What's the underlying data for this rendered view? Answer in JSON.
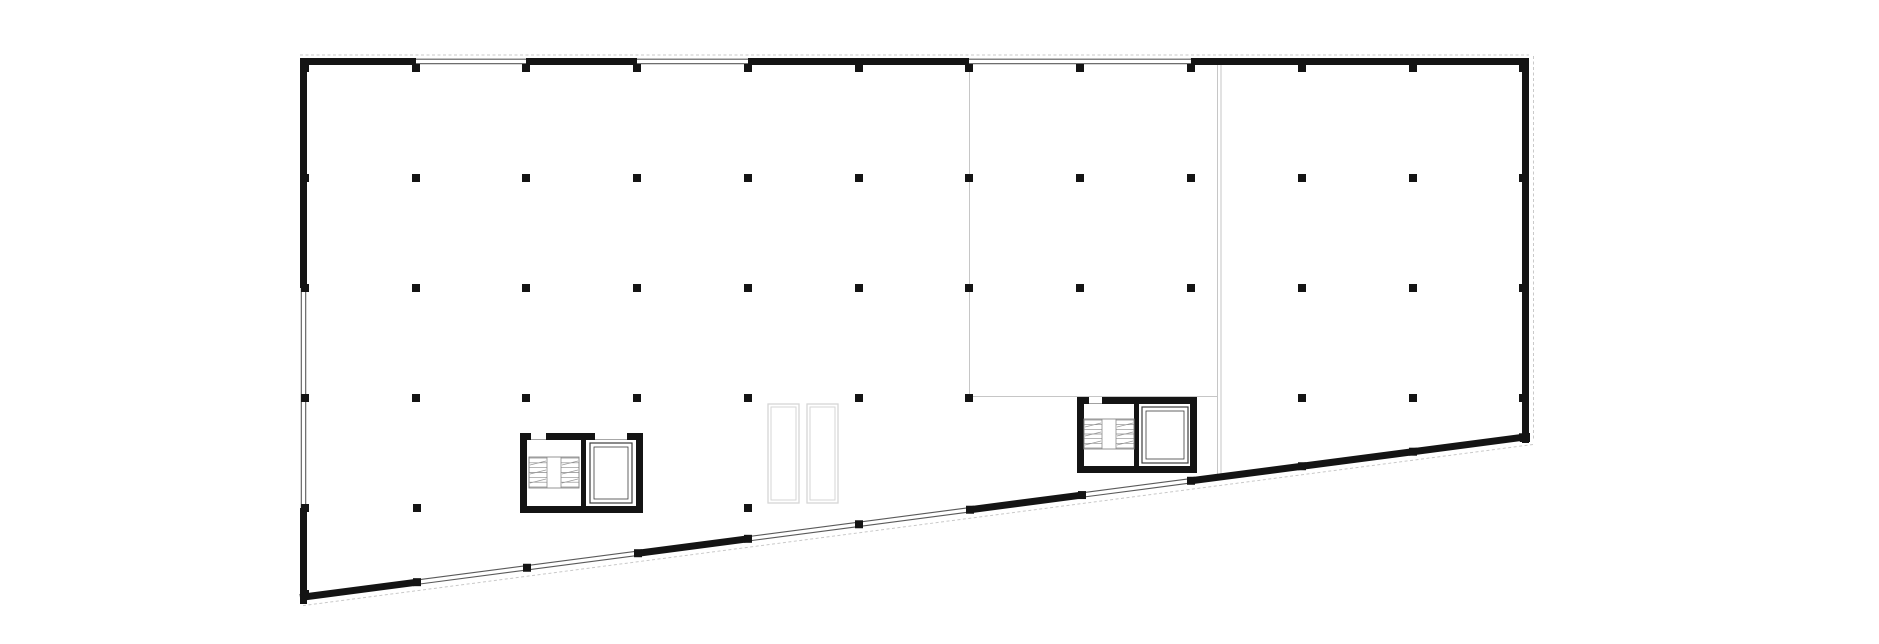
{
  "page": {
    "title": "architectural-floor-plan",
    "background": "#ffffff",
    "visible_text": []
  },
  "plan": {
    "canvas": {
      "w": 1879,
      "h": 644
    },
    "colors": {
      "wall": "#141414",
      "column": "#141414",
      "window_line": "#5a5a5a",
      "partition": "#c6c6c6",
      "dashed": "#c9c9c9",
      "lightwell": "#d6d6d6",
      "stair": "#8a8a8a",
      "elevator": "#3d3d3d",
      "white": "#ffffff"
    },
    "wall_thickness": 7,
    "top_wall_y": 61.5,
    "left_wall_x": 303.5,
    "right_wall_x": 1525.5,
    "right_wall_y1": 58,
    "right_wall_y2": 443,
    "slope": {
      "x0": 300,
      "y0": 597.5,
      "x1": 1529,
      "y1": 436.5
    },
    "top_bays": [
      {
        "x1": 300,
        "x2": 416,
        "type": "solid"
      },
      {
        "x1": 416,
        "x2": 526,
        "type": "window"
      },
      {
        "x1": 526,
        "x2": 637,
        "type": "solid"
      },
      {
        "x1": 637,
        "x2": 748,
        "type": "window"
      },
      {
        "x1": 748,
        "x2": 969,
        "type": "solid"
      },
      {
        "x1": 969,
        "x2": 1191,
        "type": "window"
      },
      {
        "x1": 1191,
        "x2": 1529,
        "type": "solid"
      }
    ],
    "bottom_bays": [
      {
        "x1": 300,
        "x2": 417,
        "type": "solid"
      },
      {
        "x1": 417,
        "x2": 638,
        "type": "window"
      },
      {
        "x1": 638,
        "x2": 748,
        "type": "solid"
      },
      {
        "x1": 748,
        "x2": 969,
        "type": "window"
      },
      {
        "x1": 969,
        "x2": 1082,
        "type": "solid"
      },
      {
        "x1": 1082,
        "x2": 1191,
        "type": "window"
      },
      {
        "x1": 1191,
        "x2": 1529,
        "type": "solid"
      }
    ],
    "left_segments": [
      {
        "y1": 58,
        "y2": 288,
        "type": "solid"
      },
      {
        "y1": 288,
        "y2": 508,
        "type": "window"
      },
      {
        "y1": 508,
        "y2": 604,
        "type": "solid"
      }
    ],
    "dashed_lines": {
      "top": {
        "x1": 300,
        "y": 55,
        "x2": 1529
      },
      "right": {
        "x": 1533.5,
        "y1": 56,
        "y2": 441
      },
      "bottom_offset": 8.5
    },
    "partitions": [
      {
        "kind": "v",
        "x": 969.5,
        "y1": 65,
        "y2": 395
      },
      {
        "kind": "h",
        "y": 396.5,
        "x1": 969,
        "x2": 1218
      },
      {
        "kind": "v",
        "x": 1217.5,
        "y1": 65,
        "y2": 479
      },
      {
        "kind": "v",
        "x": 1221,
        "y1": 65,
        "y2": 479
      }
    ],
    "light_wells": [
      {
        "x": 768,
        "y": 404,
        "w": 31,
        "h": 99
      },
      {
        "x": 807,
        "y": 404,
        "w": 31,
        "h": 99
      }
    ],
    "columns": {
      "size": 8,
      "grid_x": [
        305,
        416,
        526,
        637,
        748,
        859,
        969,
        1080,
        1191,
        1302,
        1413,
        1523
      ],
      "rows": [
        {
          "y": 68,
          "exclude": []
        },
        {
          "y": 178,
          "exclude": []
        },
        {
          "y": 288,
          "exclude": []
        },
        {
          "y": 398,
          "exclude": [
            1080,
            1191
          ]
        }
      ],
      "lower_row": {
        "y": 508,
        "x": [
          305,
          417,
          748
        ]
      },
      "on_bottom_wall_x": [
        417,
        527,
        638,
        748,
        859,
        970,
        1082,
        1191,
        1302,
        1413,
        1523
      ],
      "extra": [
        [
          305,
          594
        ],
        [
          1524,
          438
        ]
      ]
    },
    "cores": [
      {
        "name": "stair-core-1",
        "outer": [
          520,
          433,
          123,
          80
        ],
        "inner": [
          527,
          440,
          109,
          66
        ],
        "divider": [
          581,
          440,
          5,
          66
        ],
        "door_gaps": [
          [
            531,
            433,
            15,
            7
          ],
          [
            595,
            433,
            32,
            7
          ]
        ],
        "stair": {
          "box": [
            529,
            457,
            50,
            31
          ],
          "left_group": [
            529,
            547
          ],
          "right_group": [
            561,
            579
          ],
          "treads": 7
        },
        "elevator": {
          "outer": [
            590,
            443,
            42,
            60
          ],
          "inner": [
            594,
            447,
            34,
            52
          ]
        }
      },
      {
        "name": "stair-core-2",
        "outer": [
          1077,
          397,
          120,
          76
        ],
        "inner": [
          1084,
          404,
          106,
          62
        ],
        "divider": [
          1134,
          404,
          5,
          62
        ],
        "door_gaps": [
          [
            1089,
            397,
            13,
            7
          ]
        ],
        "stair": {
          "box": [
            1084,
            419,
            50,
            30
          ],
          "left_group": [
            1084,
            1102
          ],
          "right_group": [
            1116,
            1134
          ],
          "treads": 7
        },
        "elevator": {
          "outer": [
            1142,
            407,
            46,
            56
          ],
          "inner": [
            1146,
            411,
            38,
            48
          ]
        }
      }
    ]
  }
}
